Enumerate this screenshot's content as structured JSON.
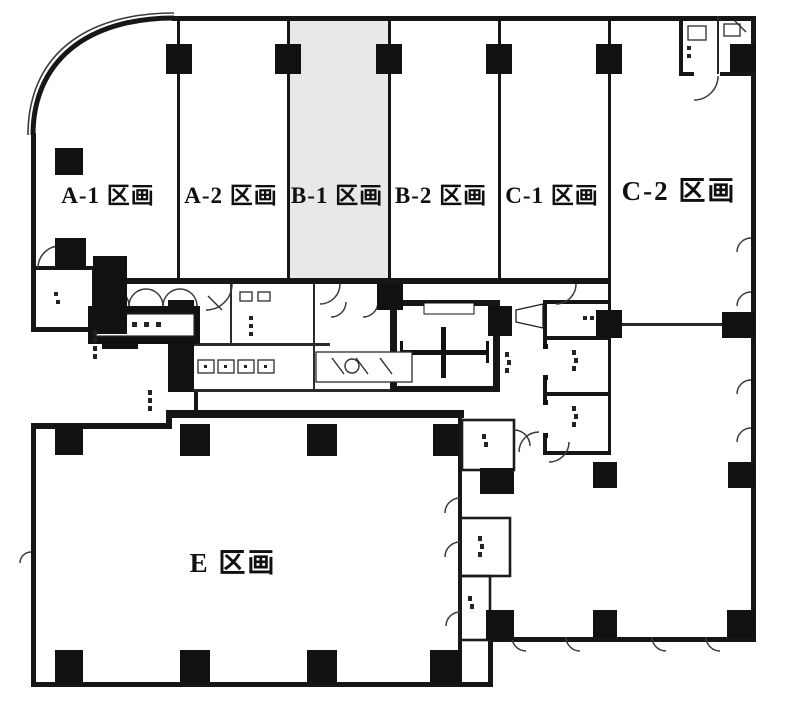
{
  "plan": {
    "type": "building-floor-plan",
    "language": "ja",
    "sections": [
      {
        "id": "A-1",
        "label": "A-1 区画",
        "highlighted": false
      },
      {
        "id": "A-2",
        "label": "A-2 区画",
        "highlighted": false
      },
      {
        "id": "B-1",
        "label": "B-1 区画",
        "highlighted": true
      },
      {
        "id": "B-2",
        "label": "B-2 区画",
        "highlighted": false
      },
      {
        "id": "C-1",
        "label": "C-1 区画",
        "highlighted": false
      },
      {
        "id": "C-2",
        "label": "C-2 区画",
        "highlighted": false
      },
      {
        "id": "E",
        "label": "E 区画",
        "highlighted": false
      }
    ],
    "features": [
      "stairwell",
      "elevator-bank",
      "restroom-block",
      "main-entrance-doors",
      "pipe-shaft-rooms",
      "corridor",
      "structural-columns",
      "door-swing-arcs"
    ],
    "colors": {
      "wall": "#161616",
      "section_highlight": "#e8e8e7",
      "floor": "#ffffff",
      "door_arc": "#3a3a3a"
    }
  }
}
